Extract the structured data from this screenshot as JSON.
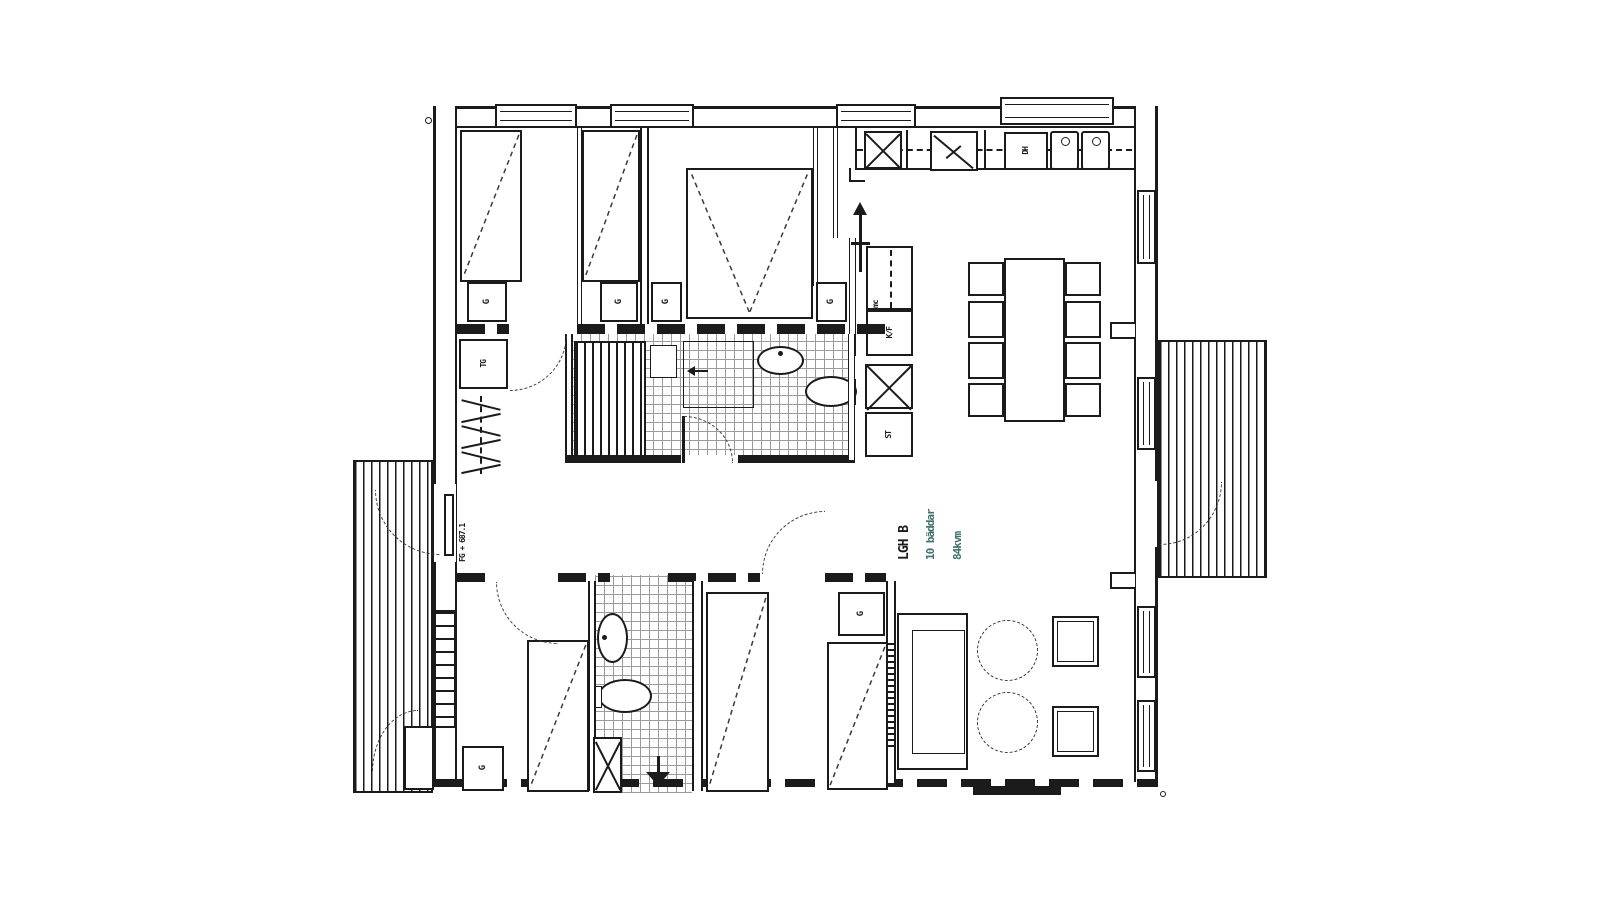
{
  "plan": {
    "title_block": {
      "apartment": "LGH B",
      "beds": "10 bäddar",
      "area": "84kvm"
    },
    "labels": {
      "wardrobe": "G",
      "drying_cabinet": "TG",
      "cleaning_closet": "ST",
      "fridge_freezer": "K/F",
      "microwave": "mc",
      "dishwasher": "DH",
      "floor_level": "FG + 687.1"
    },
    "colors": {
      "line": "#1b1b1b",
      "background": "#ffffff",
      "area_text": "#41706f",
      "tile_line": "#9b9b9b"
    }
  }
}
